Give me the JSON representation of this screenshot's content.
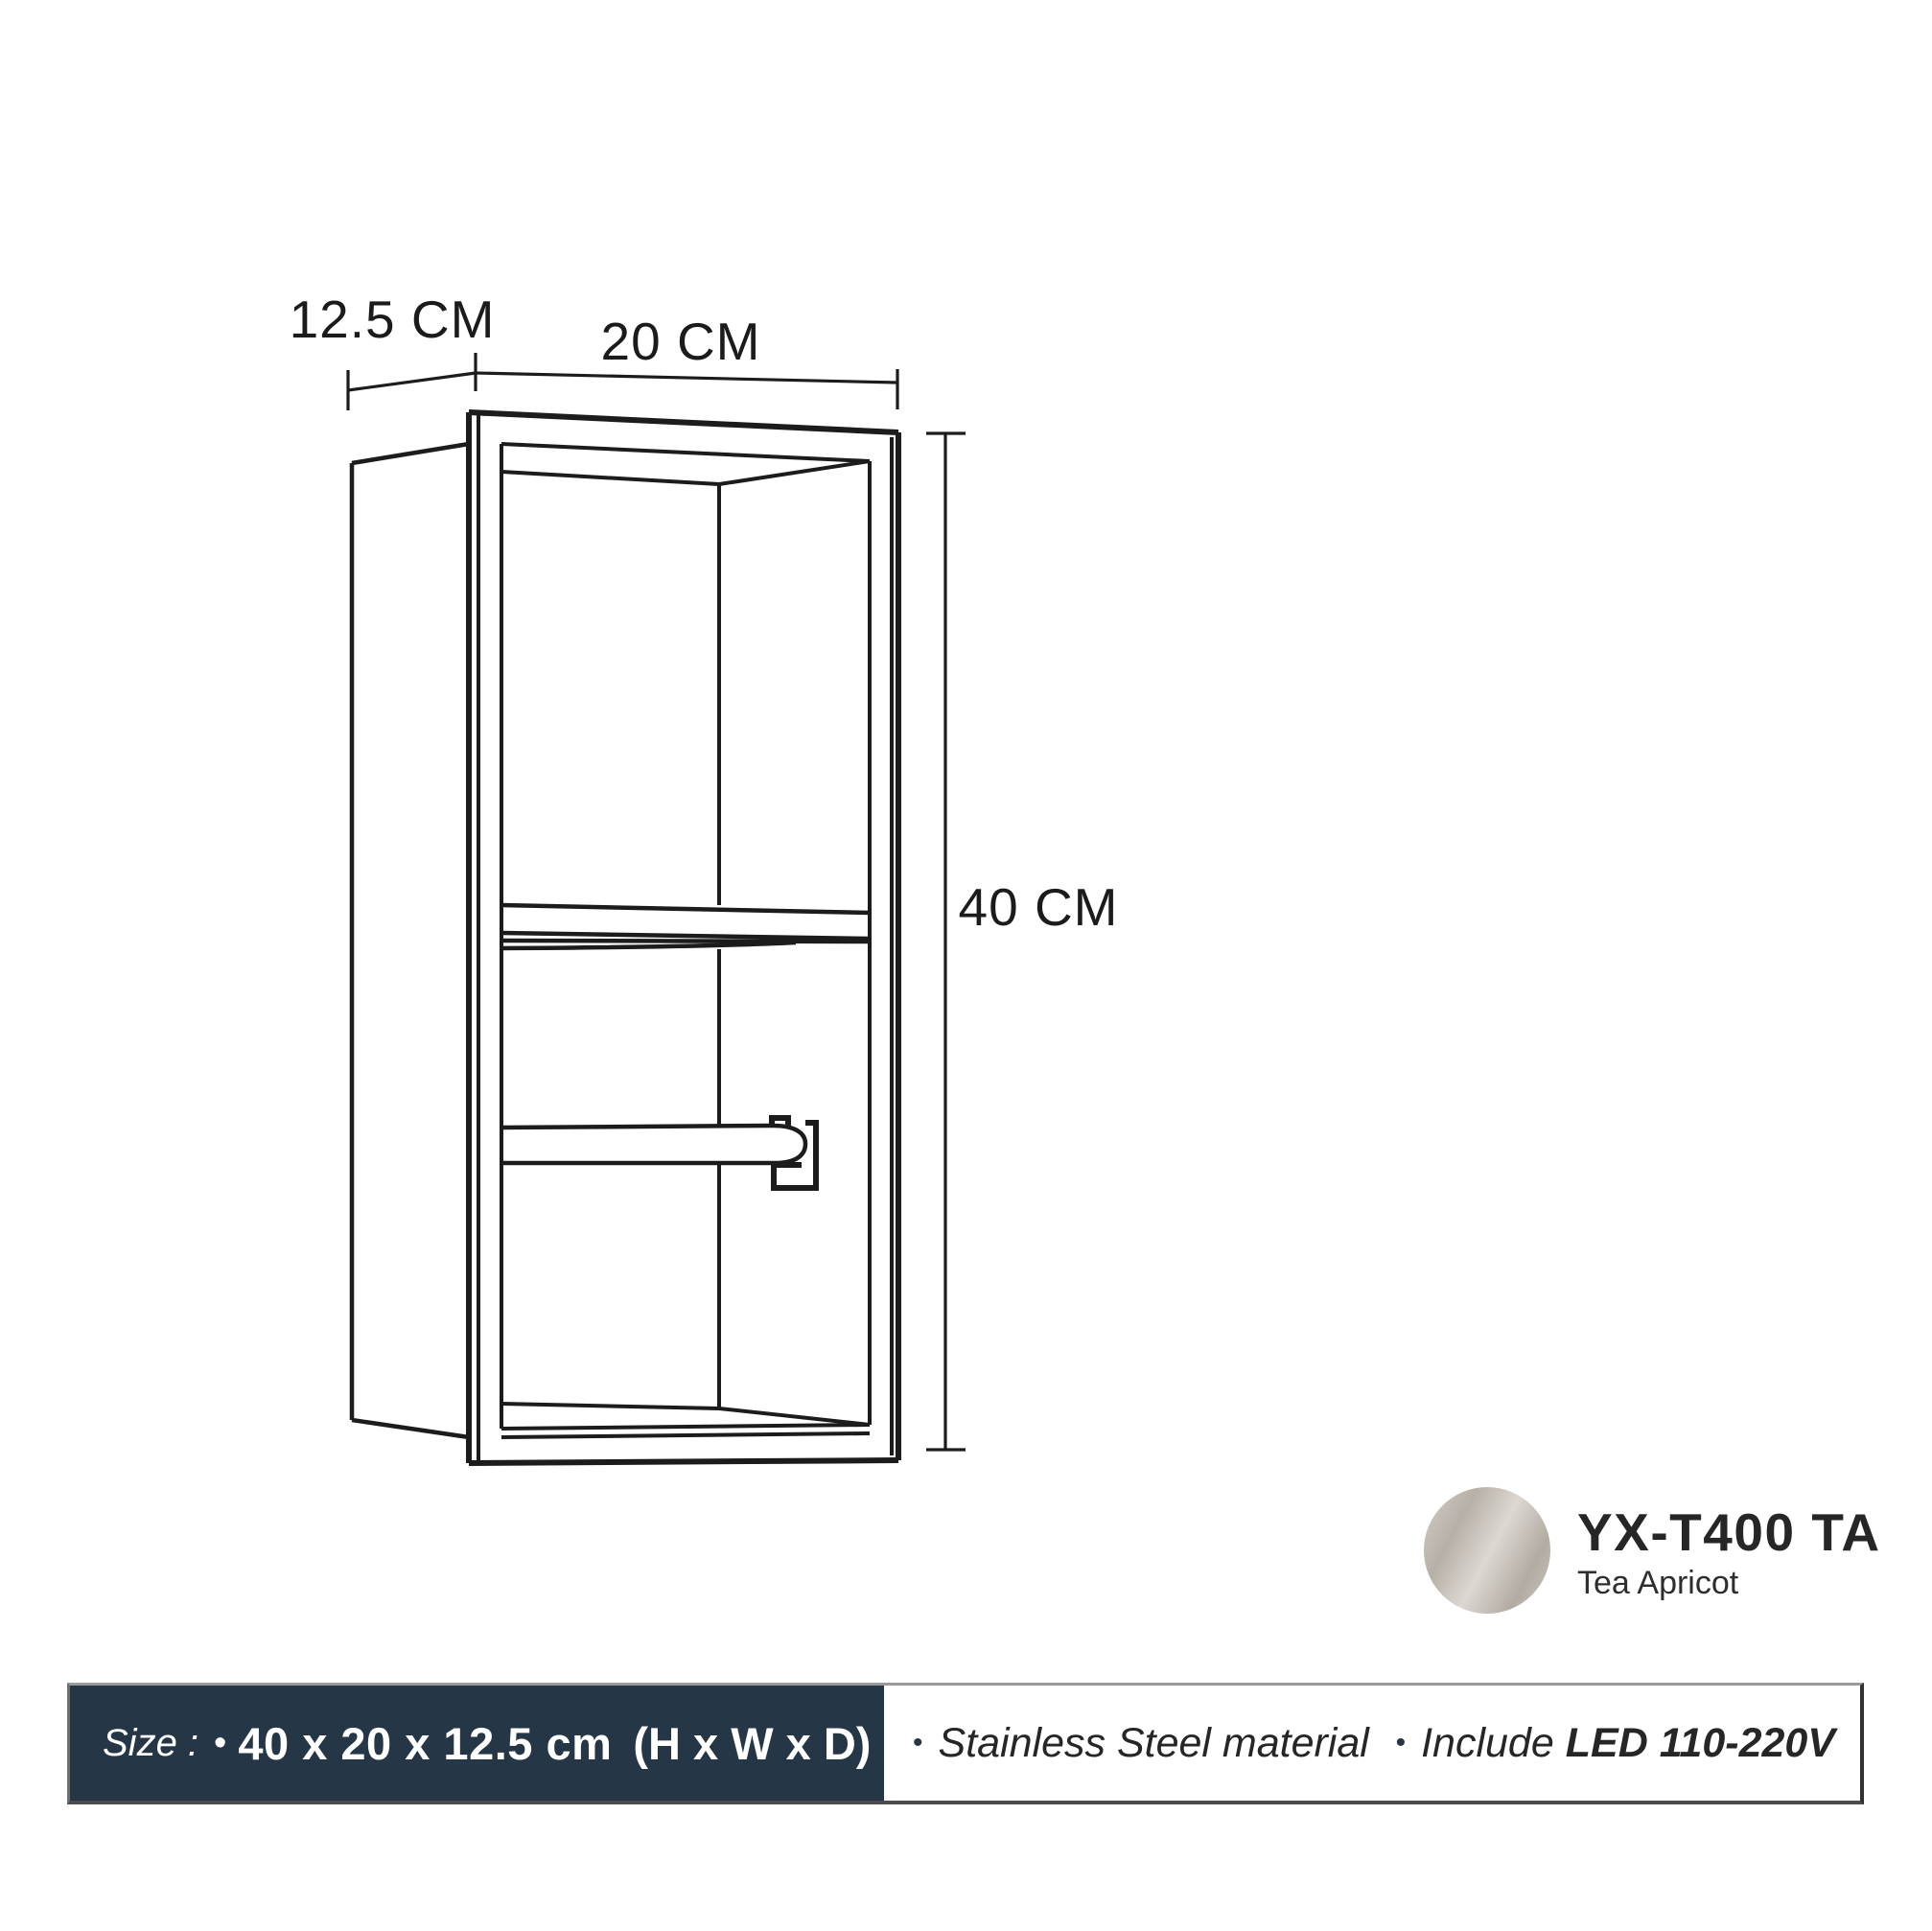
{
  "diagram": {
    "depth_label": "12.5 CM",
    "width_label": "20 CM",
    "height_label": "40 CM",
    "line_color": "#1c1c1c"
  },
  "product": {
    "model": "YX-T400 TA",
    "color_name": "Tea Apricot",
    "swatch_colors": [
      "#d3cec7",
      "#b7b0a6",
      "#dcd8d2",
      "#b2aba1",
      "#cdc7bf"
    ]
  },
  "footer": {
    "bar_color": "#253746",
    "size_label": "Size :",
    "bullet": "•",
    "size_value": "40 x 20 x 12.5 cm",
    "size_suffix": "(H x W x D)",
    "material": "Stainless Steel material",
    "include_prefix": "Include",
    "include_value": "LED 110-220V"
  }
}
